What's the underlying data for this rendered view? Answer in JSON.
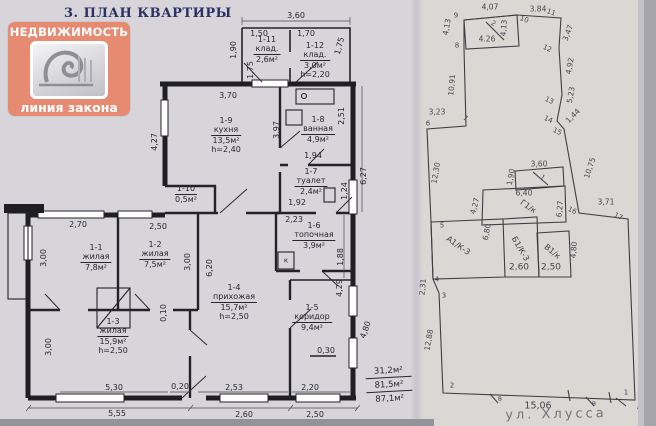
{
  "page": {
    "title": "3. ПЛАН КВАРТИРЫ"
  },
  "logo": {
    "top_text": "НЕДВИЖИМОСТЬ",
    "bottom_text": "линия закона",
    "accent_color": "#e78a72",
    "paper_color": "#d7d5da",
    "ink_color": "#26262e"
  },
  "floor_plan": {
    "rooms": [
      {
        "id": "1-11",
        "name": "клад.",
        "area": "2,6м²",
        "x": 267,
        "y": 36
      },
      {
        "id": "1-12",
        "name": "клад.",
        "area": "3,0м²",
        "h": "h=2,20",
        "x": 315,
        "y": 42
      },
      {
        "id": "1-9",
        "name": "кухня",
        "area": "13,5м²",
        "h": "h=2,40",
        "x": 226,
        "y": 117
      },
      {
        "id": "1-8",
        "name": "ванная",
        "area": "4,9м²",
        "x": 318,
        "y": 116
      },
      {
        "id": "1-7",
        "name": "туалет",
        "area": "2,4м²",
        "x": 311,
        "y": 168
      },
      {
        "id": "1-10",
        "area": "0,5м²",
        "x": 186,
        "y": 185
      },
      {
        "id": "1-6",
        "name": "топочная",
        "area": "3,9м²",
        "x": 314,
        "y": 222
      },
      {
        "id": "1-1",
        "name": "жилая",
        "area": "7,8м²",
        "x": 96,
        "y": 244
      },
      {
        "id": "1-2",
        "name": "жилая",
        "area": "7,5м²",
        "x": 155,
        "y": 241
      },
      {
        "id": "1-3",
        "name": "жилая",
        "area": "15,9м²",
        "h": "h=2,50",
        "x": 113,
        "y": 318
      },
      {
        "id": "1-4",
        "name": "прихожая",
        "area": "15,7м²",
        "h": "h=2,50",
        "x": 234,
        "y": 284
      },
      {
        "id": "1-5",
        "name": "коридор",
        "area": "9,4м²",
        "x": 312,
        "y": 304
      }
    ],
    "labels": [
      {
        "t": "3,60",
        "x": 296,
        "y": 16
      },
      {
        "t": "1,50",
        "x": 259,
        "y": 34
      },
      {
        "t": "1,70",
        "x": 306,
        "y": 34
      },
      {
        "t": "1,90",
        "x": 234,
        "y": 50,
        "r": -90
      },
      {
        "t": "1,75",
        "x": 251,
        "y": 70,
        "r": -90
      },
      {
        "t": "1,75",
        "x": 340,
        "y": 46,
        "r": -75
      },
      {
        "t": "3,70",
        "x": 228,
        "y": 96
      },
      {
        "t": "3,97",
        "x": 277,
        "y": 130,
        "r": -90
      },
      {
        "t": "2,51",
        "x": 342,
        "y": 116,
        "r": -90
      },
      {
        "t": "4,27",
        "x": 155,
        "y": 142,
        "r": -90
      },
      {
        "t": "1,94",
        "x": 313,
        "y": 156
      },
      {
        "t": "6,27",
        "x": 364,
        "y": 176,
        "r": -90
      },
      {
        "t": "1,24",
        "x": 345,
        "y": 191,
        "r": -90
      },
      {
        "t": "1,92",
        "x": 297,
        "y": 203
      },
      {
        "t": "2,23",
        "x": 294,
        "y": 220
      },
      {
        "t": "1,88",
        "x": 341,
        "y": 257,
        "r": -90
      },
      {
        "t": "к",
        "x": 286,
        "y": 261,
        "fs": 7
      },
      {
        "t": "2,70",
        "x": 78,
        "y": 225
      },
      {
        "t": "2,50",
        "x": 158,
        "y": 227
      },
      {
        "t": "3,00",
        "x": 44,
        "y": 258,
        "r": -90
      },
      {
        "t": "3,00",
        "x": 188,
        "y": 262,
        "r": -90
      },
      {
        "t": "6,20",
        "x": 210,
        "y": 268,
        "r": -90
      },
      {
        "t": "4,29",
        "x": 340,
        "y": 288,
        "r": -90
      },
      {
        "t": "0,10",
        "x": 164,
        "y": 313,
        "r": -90
      },
      {
        "t": "3,00",
        "x": 49,
        "y": 347,
        "r": -90
      },
      {
        "t": "4,80",
        "x": 366,
        "y": 330,
        "r": -70
      },
      {
        "t": "0,30",
        "x": 326,
        "y": 351
      },
      {
        "t": "5,30",
        "x": 114,
        "y": 388
      },
      {
        "t": "0,20",
        "x": 180,
        "y": 387
      },
      {
        "t": "2,53",
        "x": 234,
        "y": 388
      },
      {
        "t": "2,20",
        "x": 310,
        "y": 388
      },
      {
        "t": "5,55",
        "x": 117,
        "y": 414
      },
      {
        "t": "2,60",
        "x": 244,
        "y": 415
      },
      {
        "t": "2,50",
        "x": 315,
        "y": 415
      }
    ],
    "totals": [
      "31,2м²",
      "81,5м²",
      "87,1м²"
    ]
  },
  "plot_plan": {
    "street": "ул. Хлусса",
    "labels": [
      {
        "t": "4,07",
        "x": 70,
        "y": 7
      },
      {
        "t": "3.84",
        "x": 118,
        "y": 9
      },
      {
        "t": "9",
        "x": 36,
        "y": 16,
        "cls": "pt"
      },
      {
        "t": "10",
        "x": 104,
        "y": 20,
        "cls": "pt",
        "r": 20
      },
      {
        "t": "11",
        "x": 131,
        "y": 13,
        "cls": "pt",
        "r": 20
      },
      {
        "t": "4,13",
        "x": 27,
        "y": 27,
        "r": -80
      },
      {
        "t": "4,13",
        "x": 84,
        "y": 28,
        "r": -85
      },
      {
        "t": "2",
        "x": 73,
        "y": 24,
        "cls": "pt",
        "r": 30
      },
      {
        "t": "4.26",
        "x": 67,
        "y": 39
      },
      {
        "t": "8",
        "x": 37,
        "y": 46,
        "cls": "pt"
      },
      {
        "t": "3,47",
        "x": 148,
        "y": 33,
        "r": -70
      },
      {
        "t": "12",
        "x": 127,
        "y": 49,
        "cls": "pt",
        "r": 25
      },
      {
        "t": "4,92",
        "x": 150,
        "y": 66,
        "r": -80
      },
      {
        "t": "5,23",
        "x": 151,
        "y": 95,
        "r": -80
      },
      {
        "t": "13",
        "x": 129,
        "y": 101,
        "cls": "pt",
        "r": 25
      },
      {
        "t": "1,44",
        "x": 153,
        "y": 116,
        "r": -45
      },
      {
        "t": "14",
        "x": 128,
        "y": 120,
        "cls": "pt",
        "r": 25
      },
      {
        "t": "15",
        "x": 137,
        "y": 132,
        "cls": "pt",
        "r": 25
      },
      {
        "t": "10,75",
        "x": 170,
        "y": 168,
        "r": -72
      },
      {
        "t": "16",
        "x": 152,
        "y": 211,
        "cls": "pt",
        "r": 25
      },
      {
        "t": "3,71",
        "x": 186,
        "y": 202
      },
      {
        "t": "17",
        "x": 198,
        "y": 217,
        "cls": "pt",
        "r": 25
      },
      {
        "t": "24,26",
        "x": 225,
        "y": 303,
        "r": -85
      },
      {
        "t": "а",
        "x": 219,
        "y": 408,
        "cls": "pt"
      },
      {
        "t": "1",
        "x": 206,
        "y": 393,
        "cls": "pt"
      },
      {
        "t": "15,06",
        "x": 118,
        "y": 406,
        "fs": 9.5
      },
      {
        "t": "в",
        "x": 80,
        "y": 399,
        "cls": "pt"
      },
      {
        "t": "в",
        "x": 174,
        "y": 404,
        "cls": "pt"
      },
      {
        "t": "2",
        "x": 32,
        "y": 386,
        "cls": "pt"
      },
      {
        "t": "12,88",
        "x": 9,
        "y": 340,
        "r": -80
      },
      {
        "t": "3",
        "x": 24,
        "y": 296,
        "cls": "pt"
      },
      {
        "t": "2,31",
        "x": 3,
        "y": 287,
        "r": -85
      },
      {
        "t": "4",
        "x": 17,
        "y": 280,
        "cls": "pt"
      },
      {
        "t": "5",
        "x": 22,
        "y": 226,
        "cls": "pt"
      },
      {
        "t": "12,30",
        "x": 16,
        "y": 173,
        "r": -80
      },
      {
        "t": "6",
        "x": 8,
        "y": 124,
        "cls": "pt"
      },
      {
        "t": "3,23",
        "x": 17,
        "y": 112
      },
      {
        "t": "7",
        "x": 45,
        "y": 119,
        "cls": "pt",
        "r": 25
      },
      {
        "t": "10,91",
        "x": 32,
        "y": 85,
        "r": -85
      },
      {
        "t": "3,60",
        "x": 119,
        "y": 164
      },
      {
        "t": "1,90",
        "x": 91,
        "y": 177,
        "r": -80
      },
      {
        "t": "1",
        "x": 122,
        "y": 178,
        "cls": "pt",
        "r": 40
      },
      {
        "t": "6,40",
        "x": 104,
        "y": 193
      },
      {
        "t": "Г1/к",
        "x": 108,
        "y": 207,
        "cls": "bld",
        "r": 35
      },
      {
        "t": "6,27",
        "x": 140,
        "y": 209,
        "r": -85
      },
      {
        "t": "4,27",
        "x": 55,
        "y": 206,
        "r": -75
      },
      {
        "t": "А1/К-3",
        "x": 38,
        "y": 246,
        "cls": "bld",
        "r": 35
      },
      {
        "t": "6,80",
        "x": 67,
        "y": 232,
        "r": -80
      },
      {
        "t": "Б1/К-3",
        "x": 100,
        "y": 249,
        "cls": "bld",
        "r": 60
      },
      {
        "t": "В1/к",
        "x": 132,
        "y": 252,
        "cls": "bld",
        "r": 40
      },
      {
        "t": "2,60",
        "x": 99,
        "y": 268,
        "fs": 9
      },
      {
        "t": "2,50",
        "x": 131,
        "y": 268,
        "fs": 9
      },
      {
        "t": "4,80",
        "x": 154,
        "y": 250,
        "r": -85
      }
    ]
  }
}
